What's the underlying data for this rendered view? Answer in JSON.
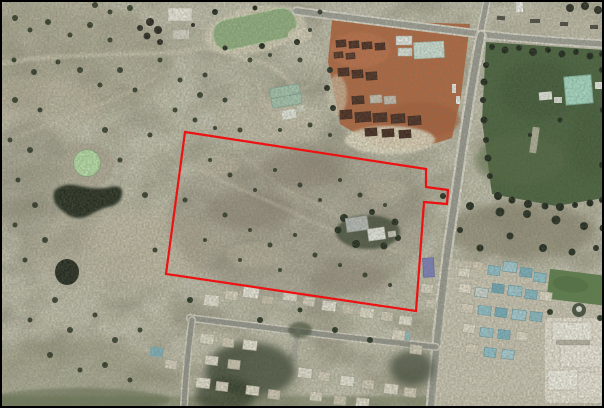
{
  "view": {
    "width": 604,
    "height": 408,
    "description": "Aerial photograph of a semi-rural town edge with a red surveyed site boundary overlay",
    "frame_color": "#000000"
  },
  "boundary": {
    "name": "site-boundary",
    "color": "#ee1111",
    "stroke_width": 2.2,
    "points": "185,132 426,169 426,187 448,190 447,204 424,202 416,311 166,274"
  },
  "palette": {
    "ground": "#a8a291",
    "pale_sand": "#c8c1aa",
    "dark_scrub": "#27301f",
    "dam_water": "#92b180",
    "pond_water": "#b9e0a8",
    "dark_water": "#242c1f",
    "industrial_dirt": "#b4673f",
    "stack_brown": "#47281c",
    "road_core": "#9a9b92",
    "road_shoulder": "#ddd9cb",
    "paddock_green": "#46613b",
    "court_teal": "#a7dcc6",
    "roof_white": "#eae6d8",
    "roof_teal": "#8fc3cd",
    "lawn_green": "#5c7f4a",
    "blue_building": "#7b80bd"
  },
  "features": {
    "water": [
      "farm-dam",
      "circular-pond",
      "dark-dam",
      "small-dark-dam"
    ],
    "areas": [
      "industrial-yard",
      "green-paddock",
      "subject-parcel",
      "residential-south",
      "new-development-east"
    ],
    "roads": [
      "top-road",
      "main-road-north-south",
      "residential-street",
      "street-stub"
    ],
    "buildings": [
      "top-left-sheds",
      "green-roof-shed",
      "yard-sheds",
      "homestead",
      "blue-building",
      "large-white-complex",
      "court-structure"
    ]
  }
}
